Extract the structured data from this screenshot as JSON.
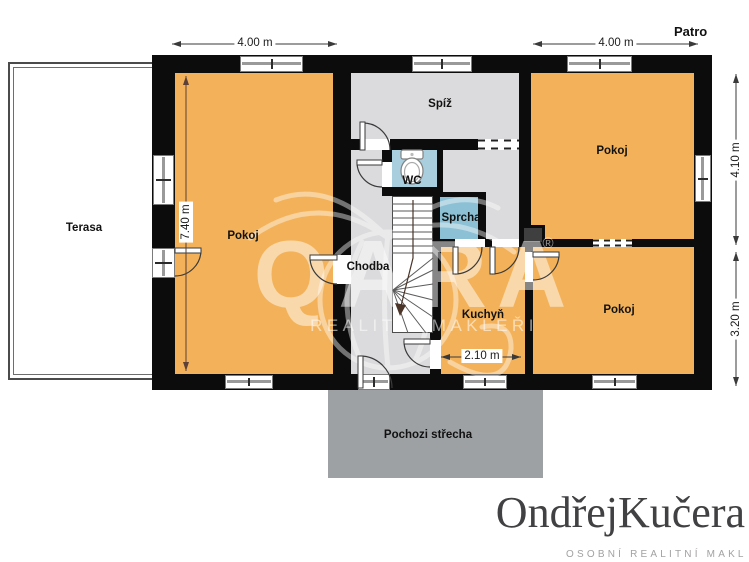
{
  "header": {
    "floor_label": "Patro"
  },
  "rooms": {
    "terasa": "Terasa",
    "pokoj_left": "Pokoj",
    "spiz": "Spíž",
    "pokoj_top_right": "Pokoj",
    "wc": "WC",
    "sprcha": "Sprcha",
    "chodba": "Chodba",
    "kuchyn": "Kuchyň",
    "pokoj_bottom_right": "Pokoj",
    "pochozi_strecha": "Pochozi střecha"
  },
  "dimensions": {
    "top_left_width": "4.00 m",
    "top_right_width": "4.00 m",
    "right_upper_height": "4.10 m",
    "right_lower_height": "3.20 m",
    "pokoj_left_height": "7.40 m",
    "kuchyn_width": "2.10 m"
  },
  "watermark": {
    "brand": "QARA",
    "registered": "®",
    "tagline": "REALITNÍ MAKLÉŘI"
  },
  "logo": {
    "first": "Ondřej",
    "last": "Kučera",
    "tagline": "OSOBNÍ REALITNÍ MAKL"
  },
  "icons": {
    "toilet": "toilet-icon",
    "palm": "watermark-palm-icon",
    "stairs": "staircase-icon"
  },
  "colors": {
    "room_orange": "#f3b259",
    "floor_gray": "#dbdbdd",
    "wc_blue": "#a9cedd",
    "shower_blue": "#8cc0d5",
    "roof_gray": "#9da1a4",
    "wall_black": "#0c0c0c",
    "logo_dark": "#414042",
    "logo_muted": "#a3a1a2"
  }
}
